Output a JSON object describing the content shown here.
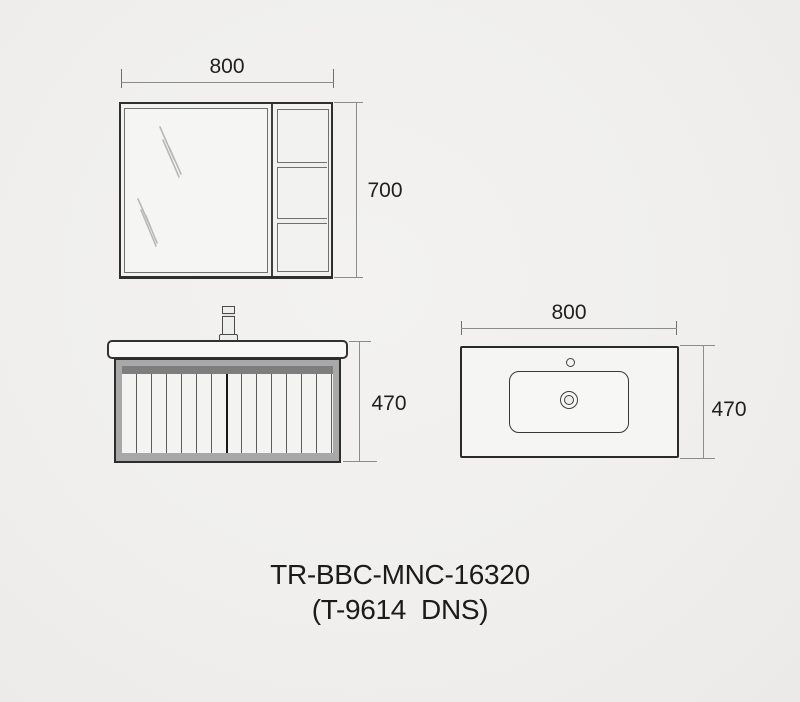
{
  "caption": {
    "model": "TR-BBC-MNC-16320",
    "variant": "(T-9614  DNS)"
  },
  "drawings": {
    "mirror_cabinet": {
      "label": "mirror cabinet front view",
      "width_mm": "800",
      "height_mm": "700"
    },
    "vanity": {
      "label": "vanity cabinet front view",
      "height_mm": "470"
    },
    "basin": {
      "label": "basin counter top view",
      "width_mm": "800",
      "depth_mm": "470"
    }
  },
  "colors": {
    "background": "#f0efed",
    "line": "#2f2f2f",
    "dim_line": "#8c8c8c",
    "frame_gray": "#a8a8a8",
    "band_gray": "#7e7e7e",
    "text": "#1b1b1b"
  }
}
